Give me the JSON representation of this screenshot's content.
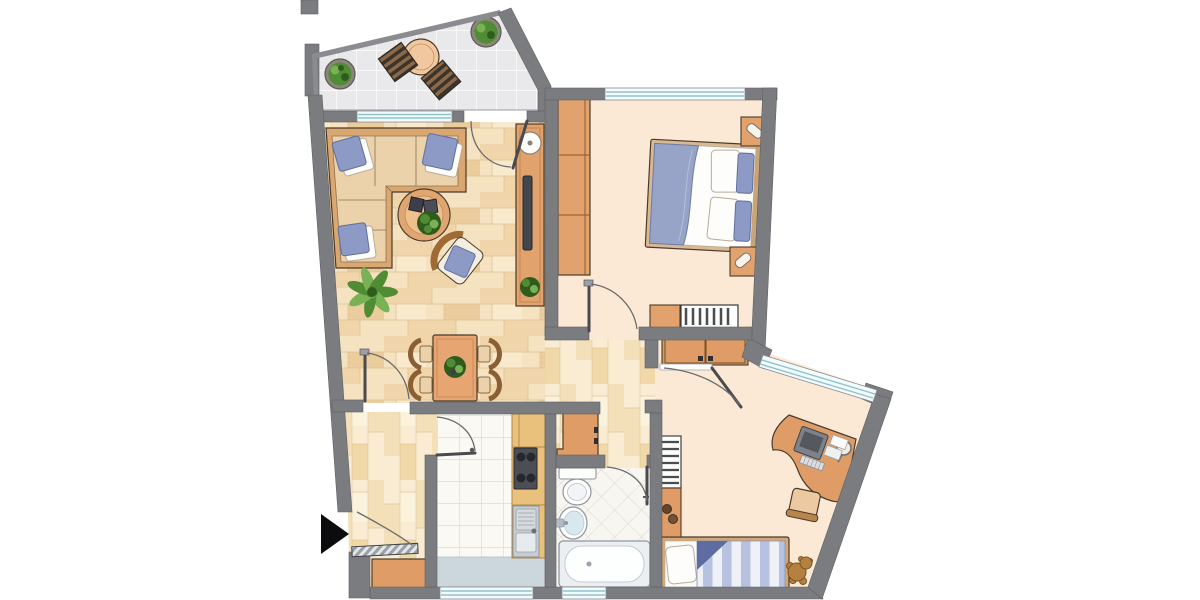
{
  "meta": {
    "description": "architectural floor plan of an apartment, top-down view, no visible text labels",
    "canvas": {
      "width": 1200,
      "height": 600
    }
  },
  "colors": {
    "wall": "#7b7c80",
    "wallEdge": "#5f6065",
    "outline": "#4a3b2a",
    "balconyTile": "#e9e9ec",
    "tileLine": "#fdfdfd",
    "rail": "#8b8c90",
    "parquetBase": "#f5e2c0",
    "parquetA": "#f0d5aa",
    "parquetB": "#ebcd9d",
    "parquetC": "#f9e9cd",
    "parquetLine": "#ddc18f",
    "hallBase": "#f9ecd2",
    "hallA": "#f4e0b8",
    "hallB": "#f0d8a9",
    "hallC": "#fbf2dd",
    "cream": "#fbe9d6",
    "kitchenTile": "#faf9f4",
    "kitchenTileLine": "#d9d6cd",
    "bathTile": "#f7f6f1",
    "bathTileLine": "#dcd9d1",
    "furn": "#e2a26d",
    "furnPanel": "#df9c66",
    "furnDark": "#9a6a38",
    "oak": "#e9c07c",
    "oakLine": "#b08a45",
    "sofaWood": "#d9a76f",
    "cushion": "#ecd2ab",
    "cushionLine": "#8a7354",
    "blue": "#8d9ac6",
    "blueLight": "#b6c0db",
    "blueDark": "#5f6f9f",
    "white": "#fdfdfb",
    "green": "#4f8c33",
    "greenLight": "#79b255",
    "greenDark": "#2f5c1d",
    "pot": "#8a867c",
    "metal": "#c6ccd2",
    "metalDark": "#8f969e",
    "stove": "#4b4f55",
    "burner": "#26282b",
    "tv": "#42464d",
    "glass": "#8fc3cd",
    "windowFill": "#f4fbfd",
    "frame": "#8a8b8f",
    "mat": "#ccd7dd",
    "tub": "#eceff2",
    "basin": "#d9e7ef",
    "teddy": "#b5813f",
    "teddyDark": "#7a5526",
    "arrow": "#0c0c0e",
    "door": "#4a4a4e",
    "arc": "#6a6a6e",
    "slatA": "#8c6a48",
    "slatB": "#3c342a",
    "stripeA": "#b7c2e0",
    "stripeB": "#eef1f8",
    "hatchA": "#e4e7ea",
    "hatchB": "#9aa0a6",
    "monitor": "#7e828a",
    "screen": "#55595f"
  },
  "rooms": [
    {
      "id": "balcony",
      "floor": "tile",
      "furniture": [
        "round-table",
        "chair",
        "chair",
        "potted-plant",
        "potted-plant"
      ]
    },
    {
      "id": "living-room",
      "floor": "parquet",
      "furniture": [
        "corner-sofa",
        "coffee-table",
        "armchair",
        "floor-plant",
        "sideboard-with-tv",
        "dining-table",
        "dining-chairs-x4"
      ]
    },
    {
      "id": "bedroom",
      "floor": "cream",
      "furniture": [
        "double-bed",
        "nightstand-x2",
        "wardrobe",
        "dresser",
        "radiator"
      ]
    },
    {
      "id": "kids-room",
      "floor": "cream",
      "furniture": [
        "wardrobe",
        "corner-desk",
        "monitor",
        "chair",
        "single-bed",
        "teddy-bear",
        "radiator",
        "toy-shelf"
      ]
    },
    {
      "id": "kitchen",
      "floor": "tile",
      "furniture": [
        "counter",
        "stove",
        "sink",
        "floor-mat"
      ]
    },
    {
      "id": "bathroom",
      "floor": "tile-diagonal",
      "furniture": [
        "toilet",
        "washbasin",
        "bathtub"
      ]
    },
    {
      "id": "hallway",
      "floor": "plank",
      "furniture": [
        "cabinet",
        "storage-closet",
        "entrance-door",
        "entrance-arrow"
      ]
    }
  ]
}
